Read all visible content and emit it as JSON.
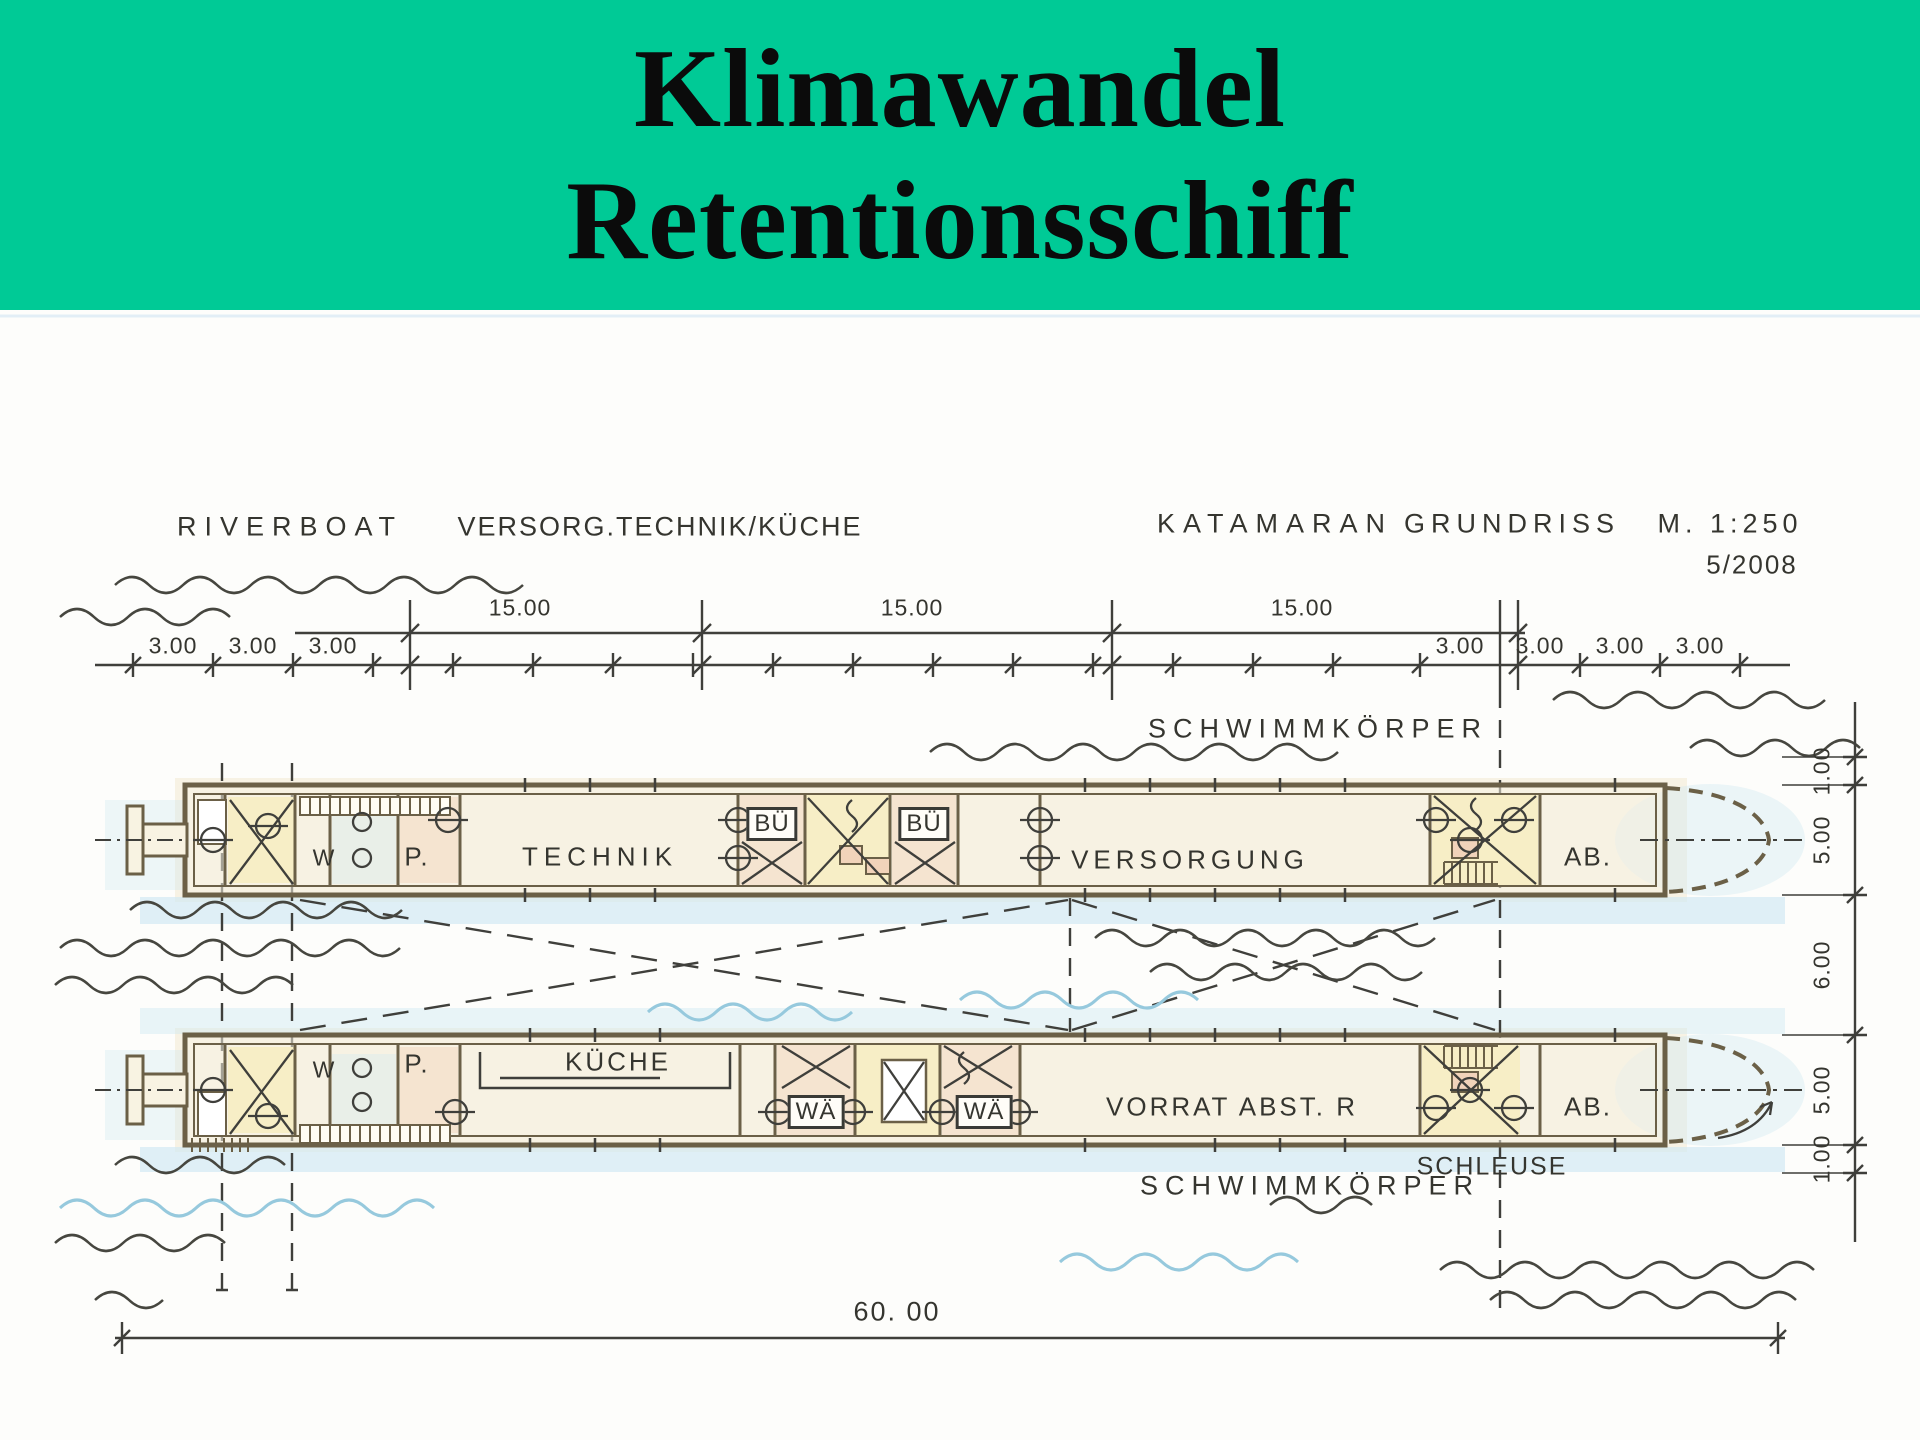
{
  "slide": {
    "header": {
      "line1": "Klimawandel",
      "line2": "Retentionsschiff",
      "bg_color": "#00CA96",
      "text_color": "#0b0b0b"
    },
    "drawing": {
      "titles": {
        "left1": "RIVERBOAT",
        "left2": "VERSORG.TECHNIK/KÜCHE",
        "right1": "KATAMARAN",
        "right2": "GRUNDRISS",
        "scale": "M. 1:250",
        "date": "5/2008"
      },
      "waterbody": {
        "top_label": "SCHWIMMKÖRPER",
        "bottom_label": "SCHWIMMKÖRPER"
      },
      "dims": {
        "top": [
          "15.00",
          "15.00",
          "15.00"
        ],
        "left": [
          "3.00",
          "3.00",
          "3.00"
        ],
        "right": [
          "3.00",
          "3.00",
          "3.00",
          "3.00"
        ],
        "side": [
          "1.00",
          "5.00",
          "6.00",
          "5.00",
          "1.00"
        ],
        "total": "60. 00"
      },
      "upper_hull": {
        "wc": "W",
        "pantry": "P.",
        "technik": "TECHNIK",
        "buero1": "BÜ",
        "buero2": "BÜ",
        "versorgung": "VERSORGUNG",
        "ab": "AB."
      },
      "lower_hull": {
        "wc": "W",
        "pantry": "P.",
        "kueche": "KÜCHE",
        "waesche1": "WÄ",
        "waesche2": "WÄ",
        "vorrat": "VORRAT  ABST. R",
        "ab": "AB.",
        "schleuse": "SCHLEUSE"
      },
      "colors": {
        "ink": "#3f3f3b",
        "wall": "#6b6047",
        "hull_fill": "#f8f3e2",
        "room_yellow": "#f5e9a4",
        "room_salmon": "#f1d3ba",
        "water_blue": "#cfe8f2",
        "wave_blue": "#96c9dd"
      }
    }
  }
}
